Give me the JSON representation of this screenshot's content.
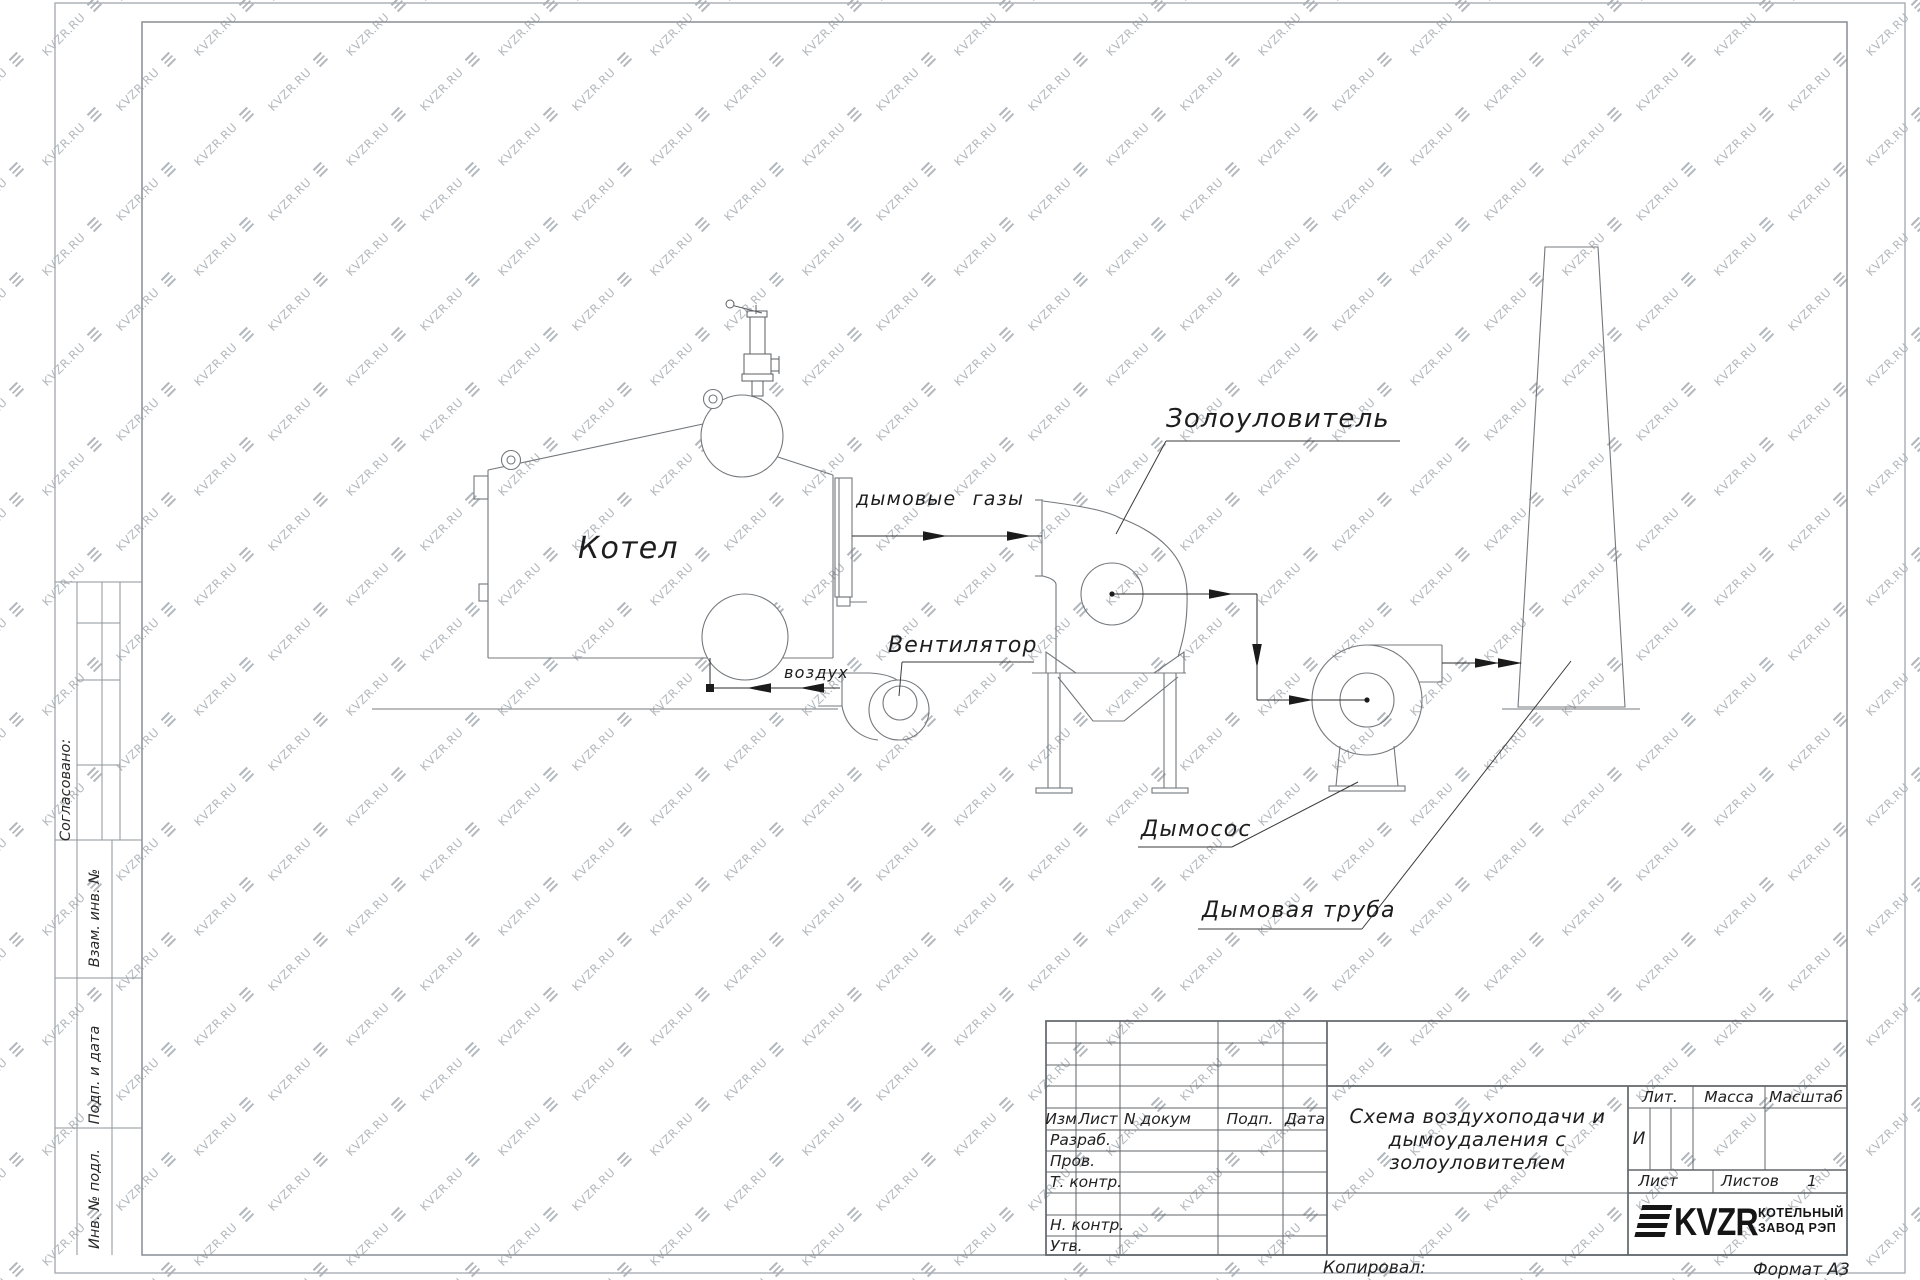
{
  "watermark": {
    "text": "KVZR.RU"
  },
  "drawing": {
    "labels": {
      "boiler": "Котел",
      "flue_gases": "дымовые газы",
      "air": "воздух",
      "fan": "Вентилятор",
      "ash_collector": "Золоуловитель",
      "smoke_exhauster": "Дымосос",
      "chimney": "Дымовая труба"
    }
  },
  "side_strip": {
    "agreed": "Согласовано:",
    "replace_inv": "Взам. инв. №",
    "sign_date": "Подп. и дата",
    "inv_orig": "Инв. № подл."
  },
  "title_block": {
    "header": {
      "izm": "Изм",
      "list": "Лист",
      "n_dokum": "N докум",
      "podp": "Подп.",
      "data": "Дата"
    },
    "rows": {
      "razrab": "Разраб.",
      "prov": "Пров.",
      "t_kontr": "Т. контр.",
      "n_kontr": "Н. контр.",
      "utv": "Утв."
    },
    "title_lines": [
      "Схема воздухоподачи и",
      "дымоудаления с",
      "золоуловителем"
    ],
    "lit_label": "Лит.",
    "lit_value": "И",
    "massa_label": "Масса",
    "masshtab_label": "Масштаб",
    "list_label": "Лист",
    "listov_label": "Листов",
    "listov_value": "1",
    "logo_text": "KVZR",
    "company_line1": "КОТЕЛЬНЫЙ",
    "company_line2": "ЗАВОД РЭП",
    "kopiroval": "Копировал:",
    "format": "Формат А3"
  }
}
